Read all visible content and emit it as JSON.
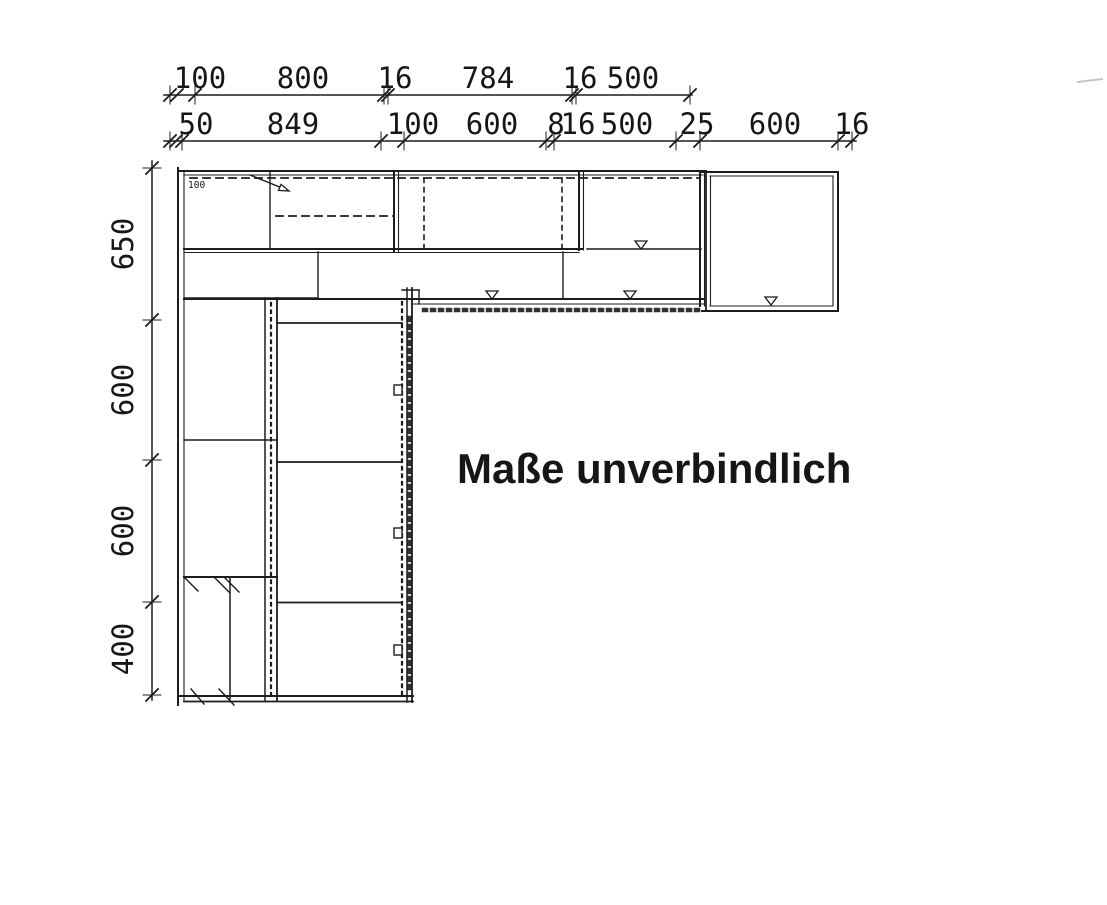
{
  "disclaimer": "Maße unverbindlich",
  "plan_annotations": {
    "corner_label": "100"
  },
  "dimensions_mm": {
    "top_row_upper": [
      "100",
      "800",
      "16",
      "784",
      "16",
      "500"
    ],
    "top_row_lower": [
      "50",
      "849",
      "100",
      "600",
      "8",
      "16",
      "500",
      "25",
      "600",
      "16"
    ],
    "left_column": [
      "650",
      "600",
      "600",
      "400"
    ]
  }
}
